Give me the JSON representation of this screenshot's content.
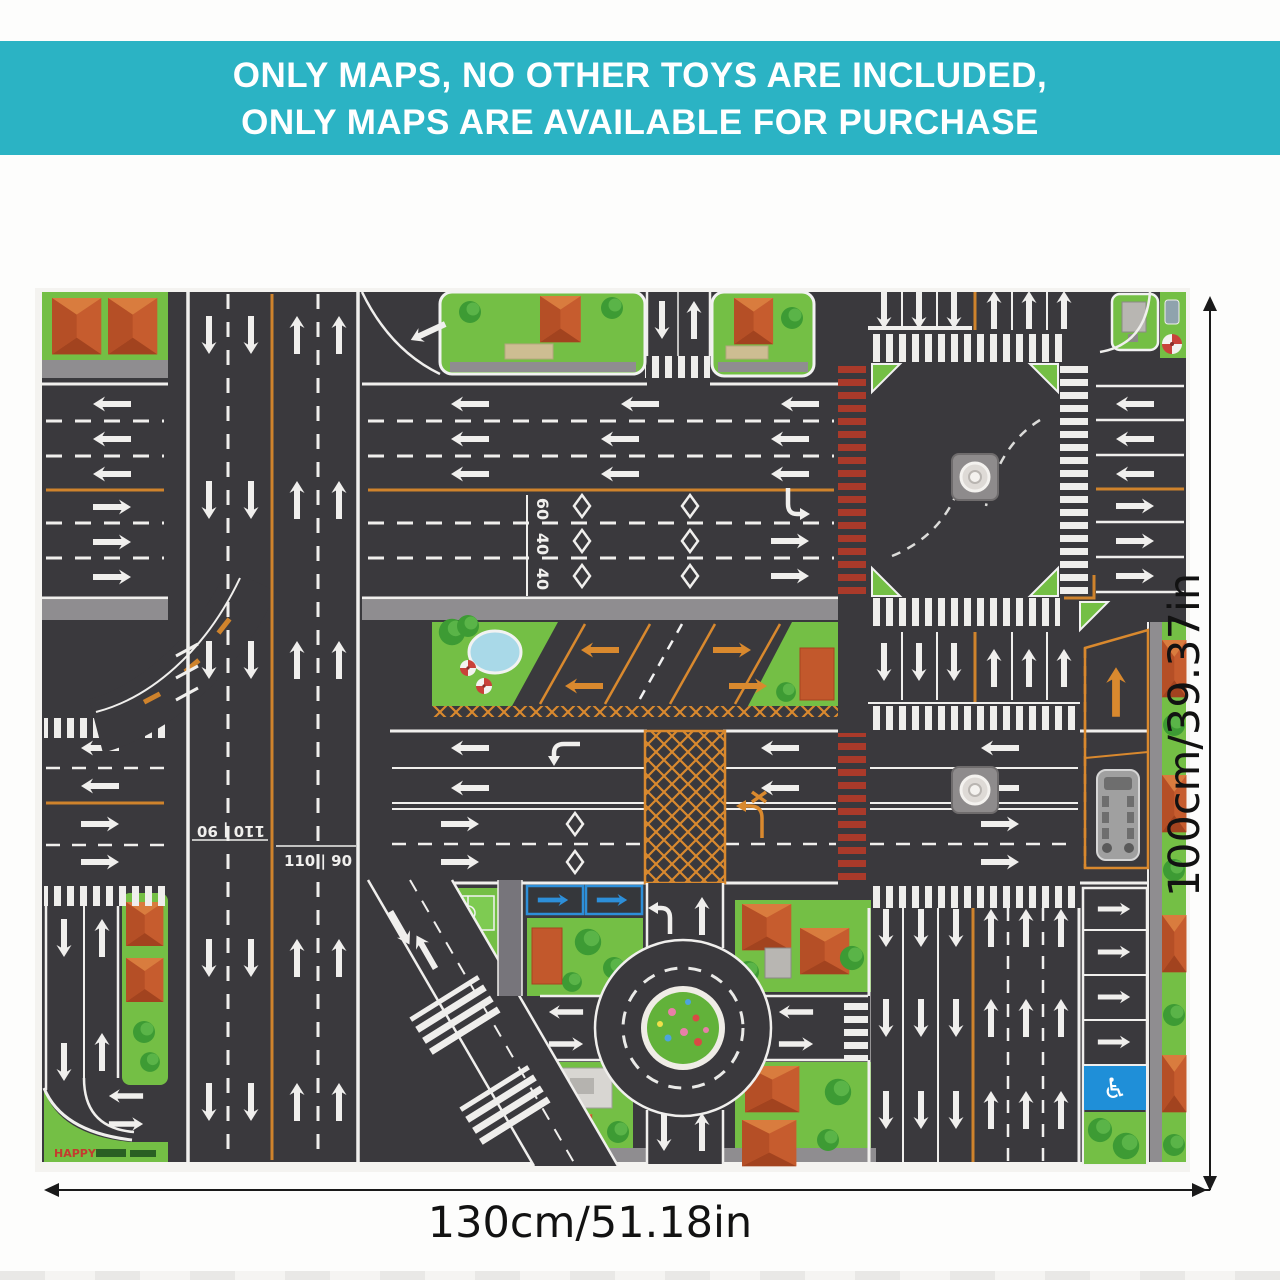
{
  "banner": {
    "line1": "ONLY MAPS, NO OTHER TOYS ARE INCLUDED,",
    "line2": "ONLY MAPS ARE AVAILABLE FOR PURCHASE"
  },
  "dimensions": {
    "width_label": "130cm/51.18in",
    "height_label": "100cm/39.37in"
  },
  "mat": {
    "type": "city-traffic-road-play-mat",
    "markings": {
      "speed_row": [
        "60",
        "40",
        "40"
      ],
      "highway_speed": "110 | 90"
    },
    "brand": {
      "logo_text": "HAPPY"
    },
    "symbols": {
      "accessible_parking": "♿"
    },
    "features": [
      "multi-lane highway",
      "signalized crossroad with zebra crossings",
      "red crosswalk",
      "roundabout with flower island",
      "parking lot",
      "bus bay",
      "accessible parking space",
      "houses and trees"
    ],
    "colors": {
      "banner_teal": "#2bb3c4",
      "road": "#3a393d",
      "grass": "#74bf45",
      "lane_white": "#f0efed",
      "lane_orange": "#cf832c",
      "red_crosswalk": "#aa3a2a",
      "roof_orange": "#c65c2e",
      "sign_blue": "#1f8fd8",
      "pond_blue": "#a9d9e8"
    }
  }
}
